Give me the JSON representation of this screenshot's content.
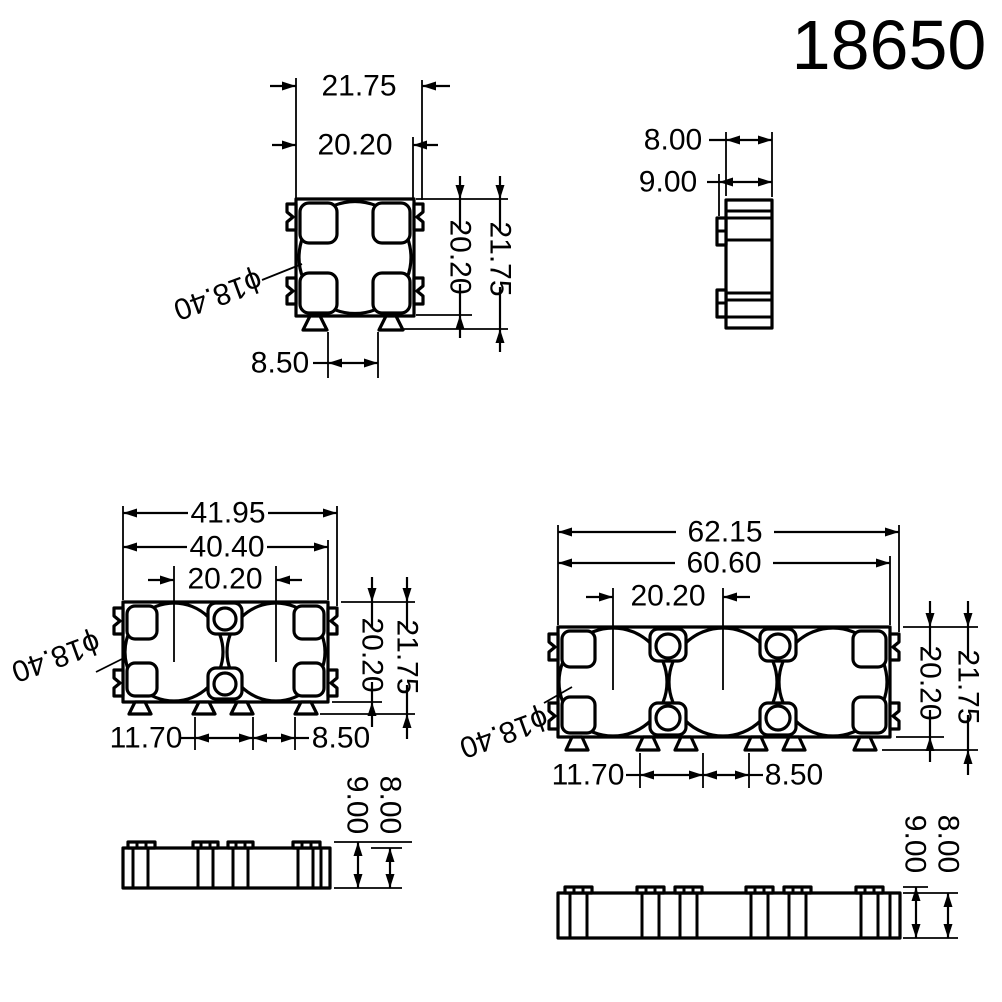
{
  "title": "18650",
  "colors": {
    "line": "#000000",
    "background": "#ffffff"
  },
  "views": {
    "single_top": {
      "overall_width": "21.75",
      "body_width": "20.20",
      "height_overall": "21.75",
      "height_body": "20.20",
      "foot_gap": "8.50",
      "bore": "ϕ18.40"
    },
    "single_side": {
      "body_depth": "8.00",
      "overall_depth": "9.00"
    },
    "double_top": {
      "overall_width": "41.95",
      "body_width": "40.40",
      "cell_pitch": "20.20",
      "height_overall": "21.75",
      "height_body": "20.20",
      "foot_pitch": "11.70",
      "foot_gap": "8.50",
      "bore": "ϕ18.40"
    },
    "double_side": {
      "overall_depth": "9.00",
      "body_depth": "8.00"
    },
    "triple_top": {
      "overall_width": "62.15",
      "body_width": "60.60",
      "cell_pitch": "20.20",
      "height_overall": "21.75",
      "height_body": "20.20",
      "foot_pitch": "11.70",
      "foot_gap": "8.50",
      "bore": "ϕ18.40"
    },
    "triple_side": {
      "overall_depth": "9.00",
      "body_depth": "8.00"
    }
  }
}
